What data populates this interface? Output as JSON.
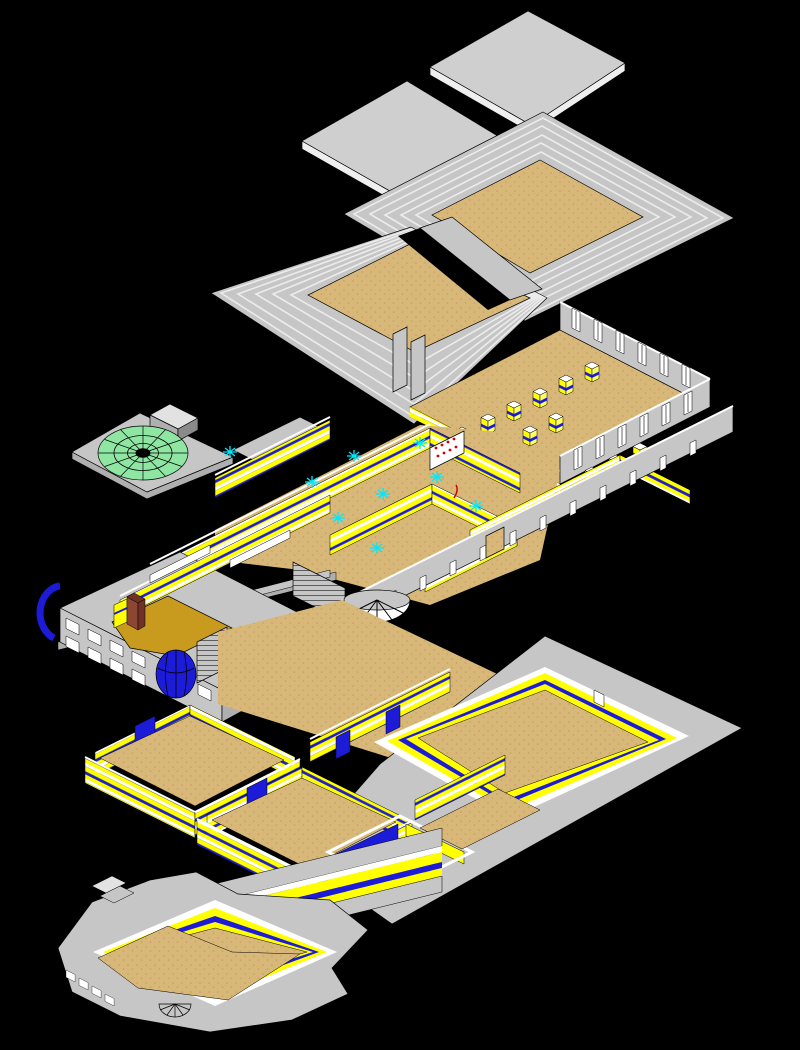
{
  "scene": {
    "type": "exploded-axonometric-cad-drawing",
    "subject": "building exploded into stacked roof and floor layers on black",
    "background": "#000000",
    "layers": [
      {
        "name": "roof-slabs"
      },
      {
        "name": "stepped-roof"
      },
      {
        "name": "dome-terrace"
      },
      {
        "name": "clerestory-floor"
      },
      {
        "name": "principal-floor"
      },
      {
        "name": "gallery-wall"
      },
      {
        "name": "ground-floor"
      },
      {
        "name": "basement-terrace"
      }
    ],
    "symbols": {
      "ceiling_light": "cyan starburst",
      "roof_dome": "green radial dome",
      "porch_dome": "blue faceted half dome",
      "apse": "white panelled drum"
    }
  },
  "palette": {
    "background": "#000000",
    "white": "#FFFFFF",
    "gray": "#C6C6C6",
    "gray_light": "#E2E2E2",
    "gray_mid": "#AFAFAF",
    "gray_dark": "#8A8A8A",
    "tan": "#D8B878",
    "tan_dot": "#C08050",
    "yellow": "#FFFF00",
    "blue": "#1C1CD8",
    "cyan": "#00E8FF",
    "green": "#8FE6A3",
    "brick": "#8C4632",
    "brick_dark": "#6E3326",
    "gold": "#C89B1E",
    "red": "#D40000"
  }
}
